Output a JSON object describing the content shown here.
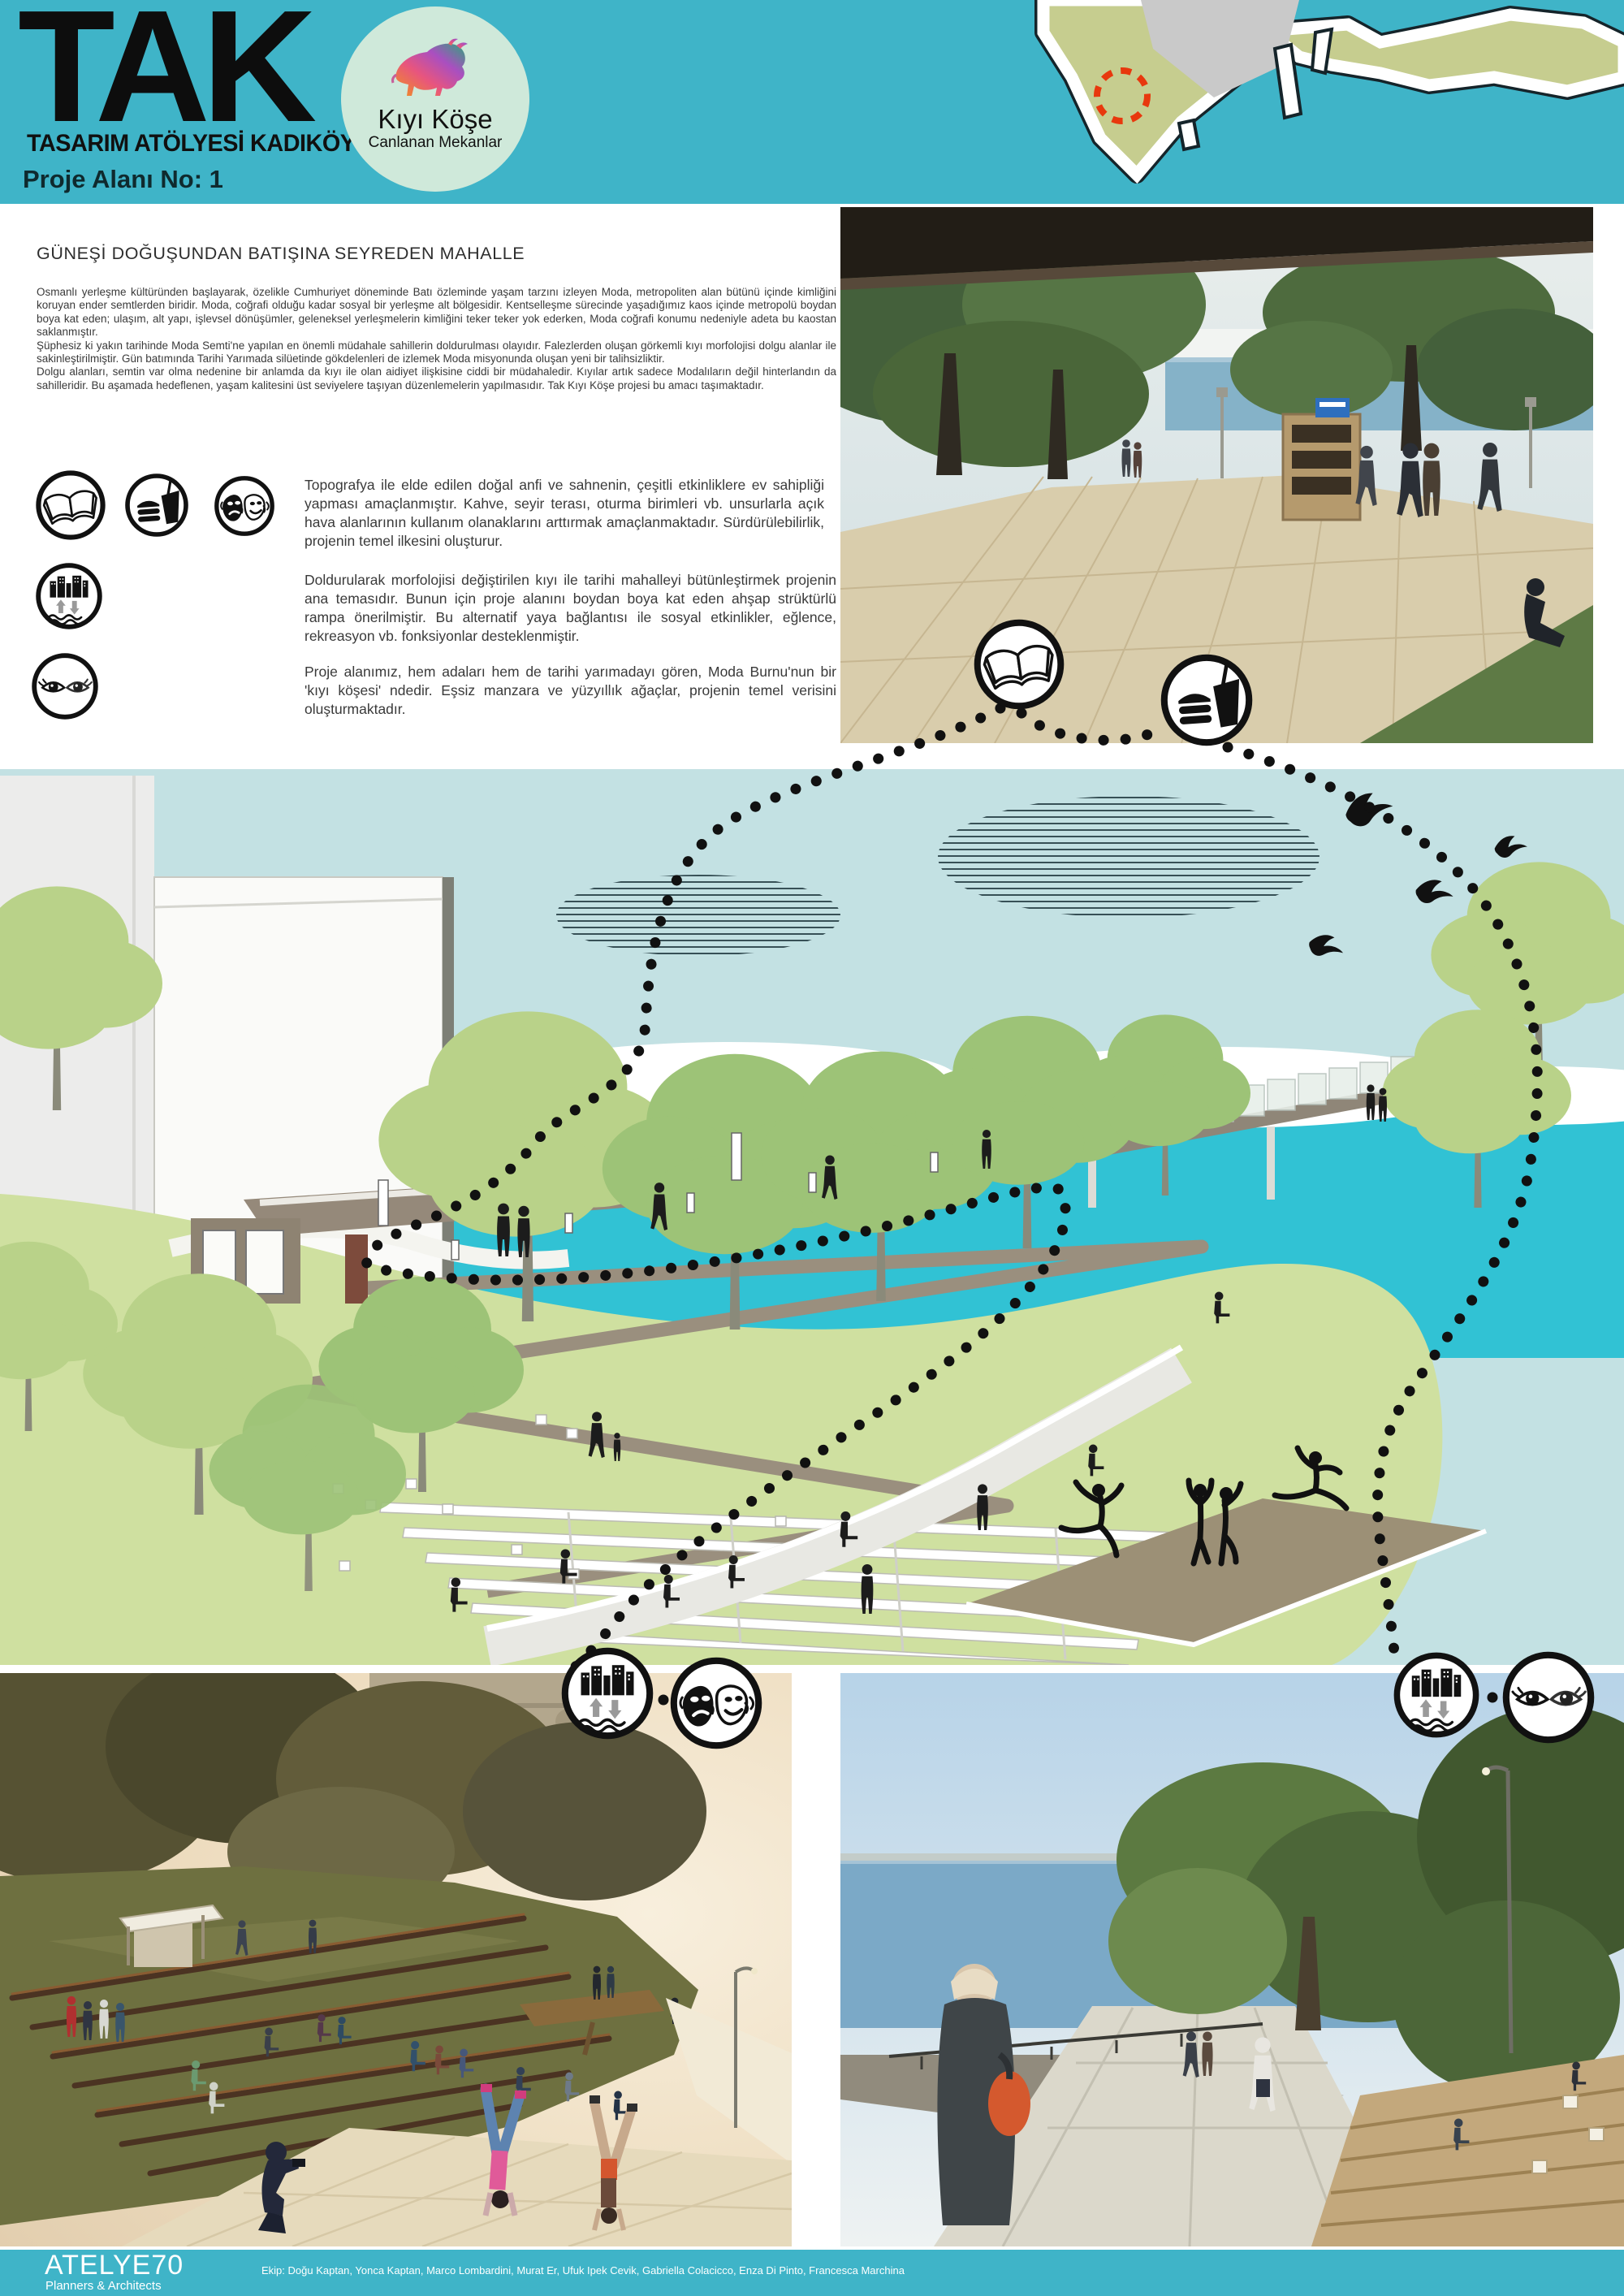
{
  "header": {
    "logo": "TAK",
    "logo_subtitle": "TASARIM ATÖLYESİ KADIKÖY",
    "project_area": "Proje Alanı No: 1",
    "badge": {
      "title": "Kıyı Köşe",
      "subtitle": "Canlanan Mekanlar",
      "icon": "bull-logo-icon"
    },
    "map": {
      "icon": "location-map",
      "marker": "red-dashed-site-marker"
    }
  },
  "content": {
    "heading": "GÜNEŞİ DOĞUŞUNDAN BATIŞINA SEYREDEN MAHALLE",
    "intro": {
      "p1": "Osmanlı yerleşme kültüründen başlayarak, özelikle Cumhuriyet döneminde Batı özleminde yaşam tarzını izleyen Moda, metropoliten alan bütünü içinde kimliğini koruyan ender semtlerden biridir. Moda, coğrafi olduğu kadar sosyal bir yerleşme alt bölgesidir. Kentselleşme sürecinde yaşadığımız kaos içinde metropolü boydan boya kat eden; ulaşım, alt yapı, işlevsel dönüşümler, geleneksel yerleşmelerin kimliğini teker teker yok ederken, Moda coğrafi konumu nedeniyle adeta bu kaostan saklanmıştır.",
      "p2": "Şüphesiz ki yakın tarihinde Moda Semti'ne yapılan en önemli müdahale sahillerin doldurulması olayıdır. Falezlerden oluşan görkemli kıyı morfolojisi dolgu alanlar ile sakinleştirilmiştir. Gün batımında Tarihi Yarımada silüetinde gökdelenleri de izlemek Moda misyonunda oluşan yeni bir talihsizliktir.",
      "p3": "Dolgu alanları, semtin var olma nedenine bir anlamda da kıyı ile olan aidiyet ilişkisine ciddi bir müdahaledir. Kıyılar artık sadece Modalıların değil hinterlandın da sahilleridir. Bu aşamada hedeflenen, yaşam kalitesini üst seviyelere taşıyan düzenlemelerin yapılmasıdır. Tak Kıyı Köşe projesi bu amacı taşımaktadır."
    },
    "features": [
      {
        "icons": [
          "open-book-icon",
          "food-drink-icon",
          "theater-masks-icon"
        ],
        "text": "Topografya ile elde edilen doğal anfi ve sahnenin, çeşitli etkinliklere ev sahipliği yapması amaçlanmıştır. Kahve, seyir terası, oturma birimleri vb. unsurlarla açık hava alanlarının kullanım olanaklarını arttırmak amaçlanmaktadır. Sürdürülebilirlik, projenin temel ilkesini oluşturur."
      },
      {
        "icons": [
          "city-waterfront-icon"
        ],
        "text": "Doldurularak morfolojisi değiştirilen kıyı ile tarihi mahalleyi bütünleştirmek projenin ana temasıdır. Bunun için proje alanını boydan boya kat eden ahşap strüktürlü rampa önerilmiştir. Bu alternatif yaya bağlantısı ile sosyal etkinlikler, eğlence, rekreasyon vb. fonksiyonlar desteklenmiştir."
      },
      {
        "icons": [
          "eyes-icon"
        ],
        "text": "Proje alanımız, hem adaları hem de tarihi yarımadayı gören, Moda Burnu'nun bir 'kıyı köşesi' ndedir. Eşsiz manzara ve yüzyıllık ağaçlar,  projenin temel verisini oluşturmaktadır."
      }
    ]
  },
  "footer": {
    "studio": "ATELYE70",
    "studio_subtitle": "Planners & Architects",
    "credits": "Ekip: Doğu Kaptan, Yonca Kaptan, Marco Lombardini, Murat Er, Ufuk Ipek Cevik, Gabriella Colacicco, Enza Di Pinto, Francesca Marchina"
  },
  "colors": {
    "band_turquoise": "#3fb4c8",
    "badge_mint": "#cfe9da",
    "map_land_olive": "#c6cd8f",
    "map_city_gray": "#c9c9c9",
    "marker_red": "#e8380d",
    "illustration_sky": "#c3e1e3",
    "illustration_sea": "#31c2d4",
    "hill_green": "#cfe0a0",
    "path_taupe": "#95897a"
  }
}
